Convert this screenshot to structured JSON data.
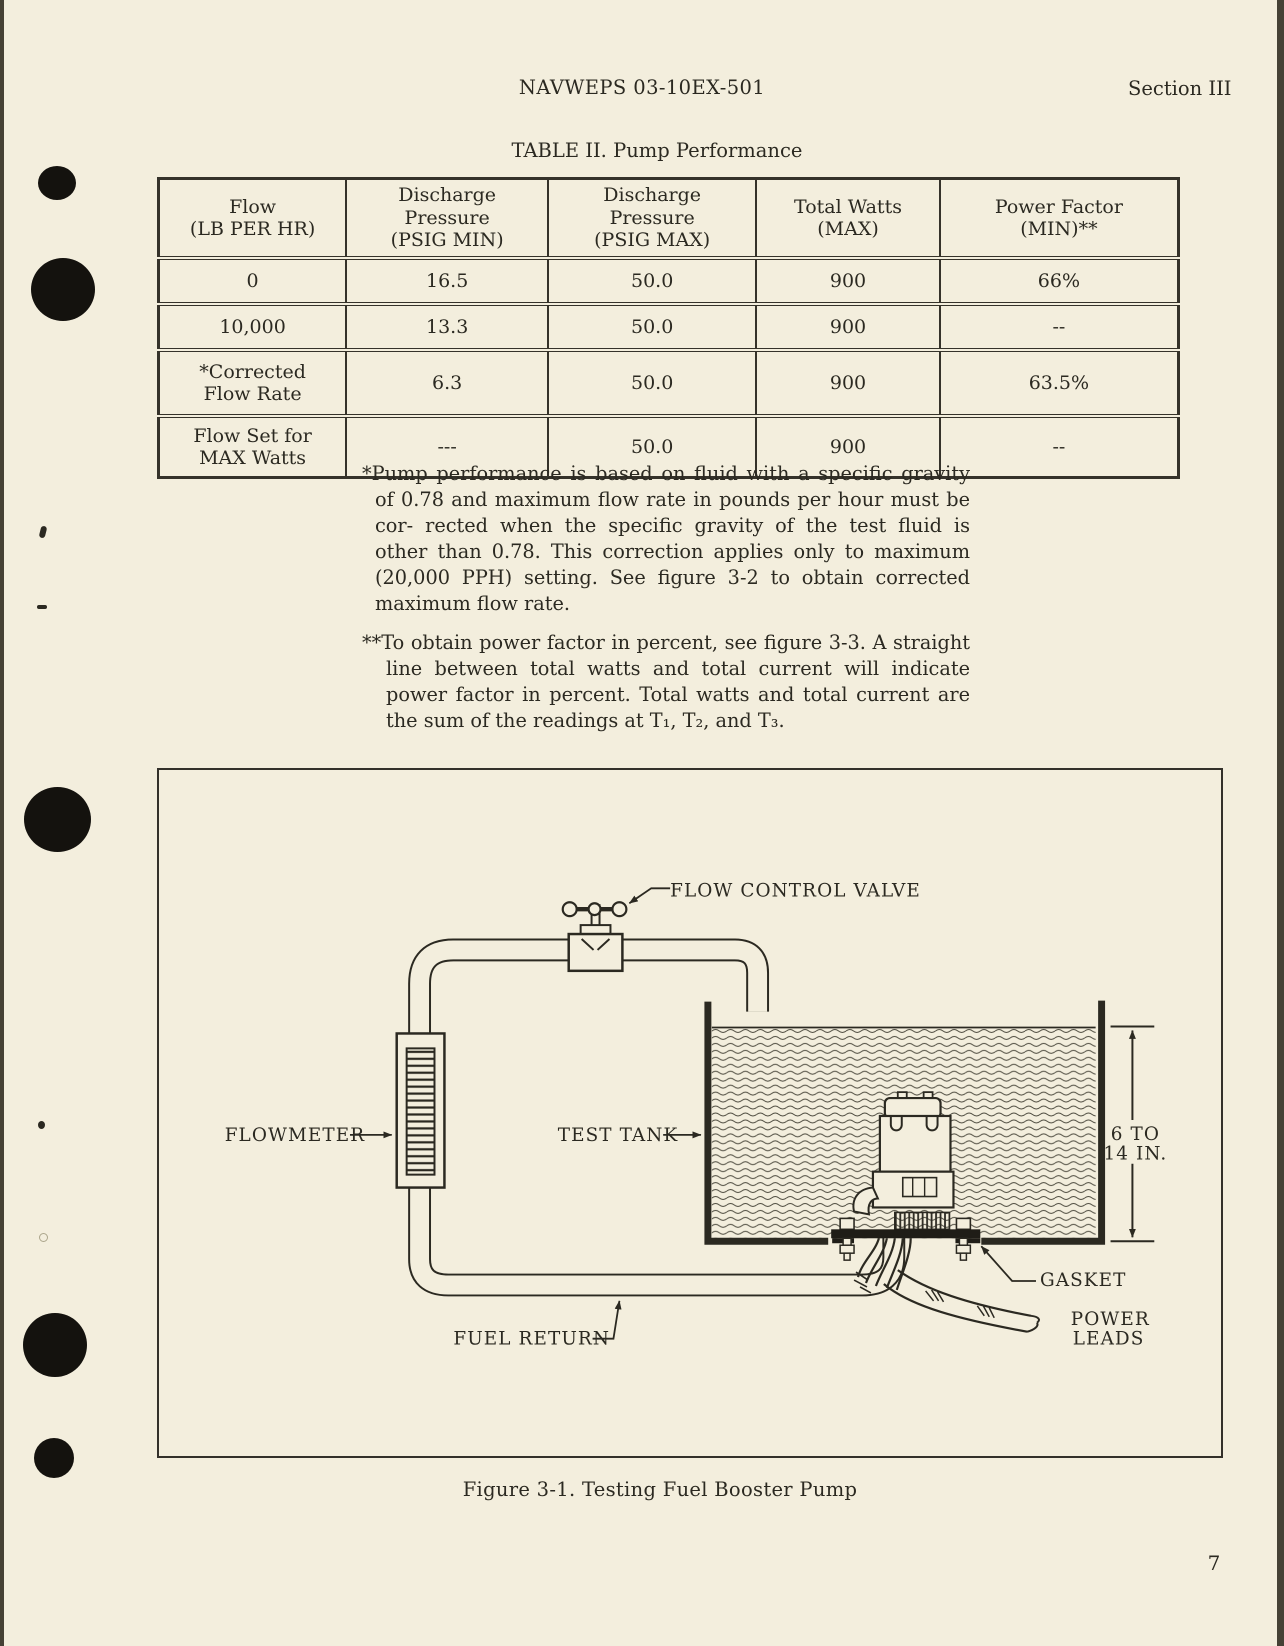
{
  "page": {
    "page_number": "7",
    "paper_color": "#f3eedd",
    "ink_color": "#2b2921"
  },
  "header": {
    "doc_number": "NAVWEPS 03-10EX-501",
    "section": "Section III"
  },
  "table": {
    "title": "TABLE II.  Pump Performance",
    "columns": [
      [
        "Flow",
        "(LB PER HR)"
      ],
      [
        "Discharge",
        "Pressure",
        "(PSIG MIN)"
      ],
      [
        "Discharge",
        "Pressure",
        "(PSIG MAX)"
      ],
      [
        "Total Watts",
        "(MAX)"
      ],
      [
        "Power Factor",
        "(MIN)**"
      ]
    ],
    "rows": [
      [
        "0",
        "16.5",
        "50.0",
        "900",
        "66%"
      ],
      [
        "10,000",
        "13.3",
        "50.0",
        "900",
        "--"
      ],
      [
        [
          "*Corrected",
          "Flow Rate"
        ],
        "6.3",
        "50.0",
        "900",
        "63.5%"
      ],
      [
        [
          "Flow Set for",
          "MAX Watts"
        ],
        "---",
        "50.0",
        "900",
        "--"
      ]
    ]
  },
  "footnotes": [
    {
      "marker": "*",
      "text": "Pump performance is based on fluid with a specific gravity of 0.78 and maximum flow rate in pounds per hour must be cor- rected when the specific gravity of the test fluid is other than 0.78.  This correction applies only to maximum (20,000 PPH) setting.  See figure 3-2 to obtain corrected maximum flow rate."
    },
    {
      "marker": "**",
      "text": "To obtain power factor in percent, see figure 3-3.  A straight line between total watts and total current will indicate power factor in percent.  Total watts and total current are the sum of the readings at T₁, T₂, and T₃."
    }
  ],
  "figure": {
    "caption": "Figure 3-1.  Testing Fuel Booster Pump",
    "labels": {
      "flow_control_valve": "FLOW CONTROL VALVE",
      "flowmeter": "FLOWMETER",
      "test_tank": "TEST TANK",
      "fuel_return": "FUEL RETURN",
      "gasket": "GASKET",
      "power_leads_line1": "POWER",
      "power_leads_line2": "LEADS",
      "dimension_line1": "6 TO",
      "dimension_line2": "14 IN."
    }
  }
}
